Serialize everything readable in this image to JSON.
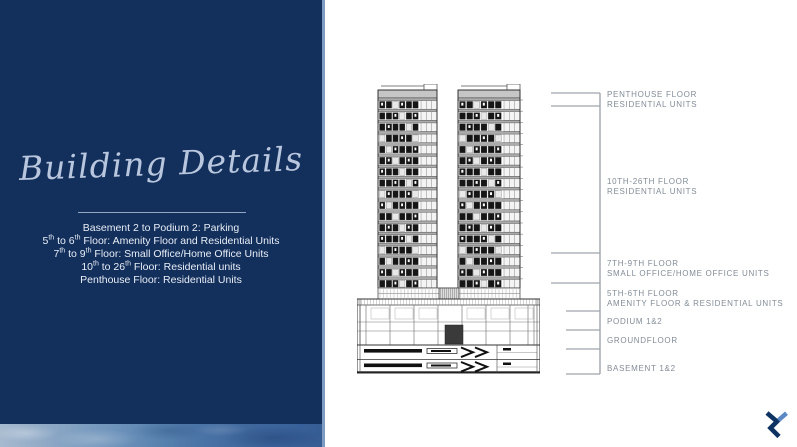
{
  "left_panel": {
    "title": "Building Details",
    "lines": [
      {
        "parts": [
          {
            "text": "Basement 2 to Podium 2: Parking"
          }
        ]
      },
      {
        "parts": [
          {
            "text": "5"
          },
          {
            "text": "th",
            "sup": true
          },
          {
            "text": " to 6"
          },
          {
            "text": "th",
            "sup": true
          },
          {
            "text": " Floor: Amenity Floor and Residential Units"
          }
        ]
      },
      {
        "parts": [
          {
            "text": "7"
          },
          {
            "text": "th",
            "sup": true
          },
          {
            "text": " to 9"
          },
          {
            "text": "th",
            "sup": true
          },
          {
            "text": " Floor: Small Office/Home Office Units"
          }
        ]
      },
      {
        "parts": [
          {
            "text": "10"
          },
          {
            "text": "th",
            "sup": true
          },
          {
            "text": " to 26"
          },
          {
            "text": "th",
            "sup": true
          },
          {
            "text": " Floor: Residential units"
          }
        ]
      },
      {
        "parts": [
          {
            "text": "Penthouse Floor: Residential Units"
          }
        ]
      }
    ]
  },
  "elevation": {
    "labels": [
      {
        "line1": "PENTHOUSE FLOOR",
        "line2": "RESIDENTIAL UNITS"
      },
      {
        "line1": "10TH-26TH FLOOR",
        "line2": "RESIDENTIAL UNITS"
      },
      {
        "line1": "7TH-9TH FLOOR",
        "line2": "SMALL OFFICE/HOME OFFICE UNITS"
      },
      {
        "line1": "5TH-6TH FLOOR",
        "line2": "AMENITY FLOOR & RESIDENTIAL UNITS"
      },
      {
        "line1": "PODIUM 1&2",
        "line2": ""
      },
      {
        "line1": "GROUNDFLOOR",
        "line2": ""
      },
      {
        "line1": "BASEMENT 1&2",
        "line2": ""
      }
    ]
  },
  "icons": {
    "brand_logo": "chevron-zigzag-logo"
  },
  "colors": {
    "panel_navy": "#132f5c",
    "panel_edge_blue": "#7e9cc2",
    "title_blue": "#b9c7de",
    "body_text": "#e8eef6",
    "label_gray": "#828c96",
    "leader_line_gray": "#9fa5ab",
    "logo_dark": "#0e3363",
    "logo_light": "#5c88c4"
  }
}
